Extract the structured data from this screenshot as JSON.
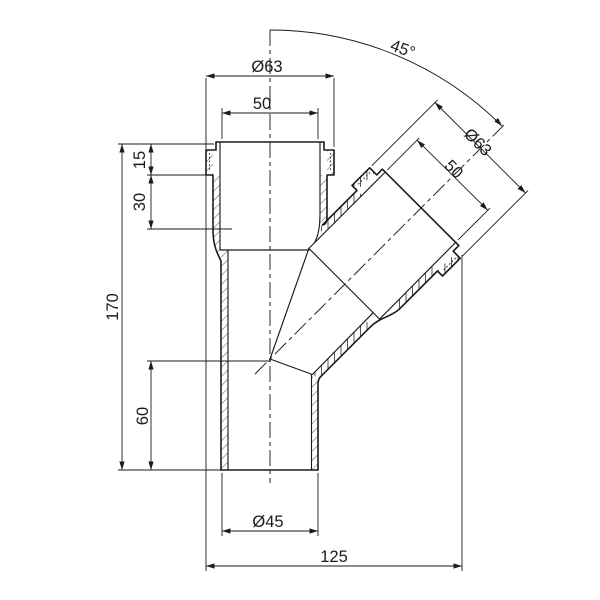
{
  "drawing": {
    "title": "45-degree branch pipe fitting, section view",
    "colors": {
      "line": "#1b1b1b",
      "background": "#ffffff"
    },
    "dimensions": {
      "top_outer_diameter": "Ø63",
      "top_socket_width": "50",
      "collar_height": "15",
      "socket_depth": "30",
      "overall_height": "170",
      "branch_axis_height": "60",
      "pipe_outer_diameter": "Ø45",
      "overall_width": "125",
      "branch_angle": "45°",
      "branch_outer_diameter": "Ø63",
      "branch_socket_width": "50"
    }
  }
}
